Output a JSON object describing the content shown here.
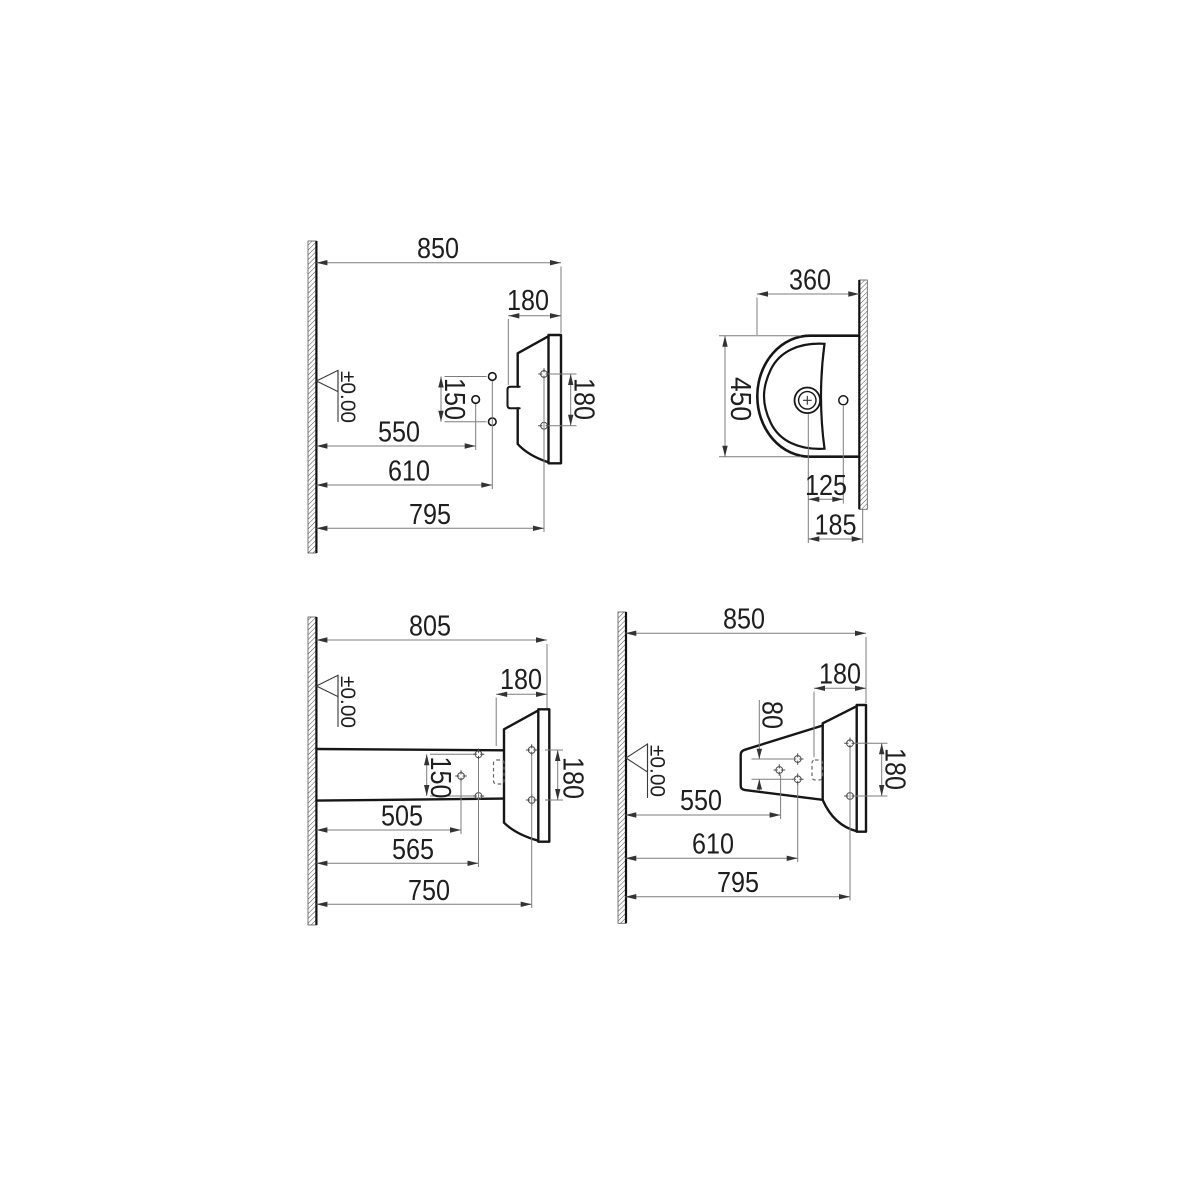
{
  "colors": {
    "outline": "#161616",
    "dimension_line": "#7d7d7d",
    "text": "#1e1e1e",
    "arrow": "#333333",
    "background": "#ffffff"
  },
  "views": {
    "top_left": {
      "d850": "850",
      "d180_top": "180",
      "d150": "150",
      "d550": "550",
      "d610": "610",
      "d795": "795",
      "d180_holes": "180",
      "datum": "±0.00"
    },
    "top_right": {
      "d360": "360",
      "d450": "450",
      "d125": "125",
      "d185": "185"
    },
    "bottom_left": {
      "d805": "805",
      "d180_top": "180",
      "d150": "150",
      "d505": "505",
      "d565": "565",
      "d750": "750",
      "d180_holes": "180",
      "datum": "±0.00"
    },
    "bottom_right": {
      "d850": "850",
      "d180_top": "180",
      "d80": "80",
      "d550": "550",
      "d610": "610",
      "d795": "795",
      "d180_holes": "180",
      "datum": "±0.00"
    }
  }
}
